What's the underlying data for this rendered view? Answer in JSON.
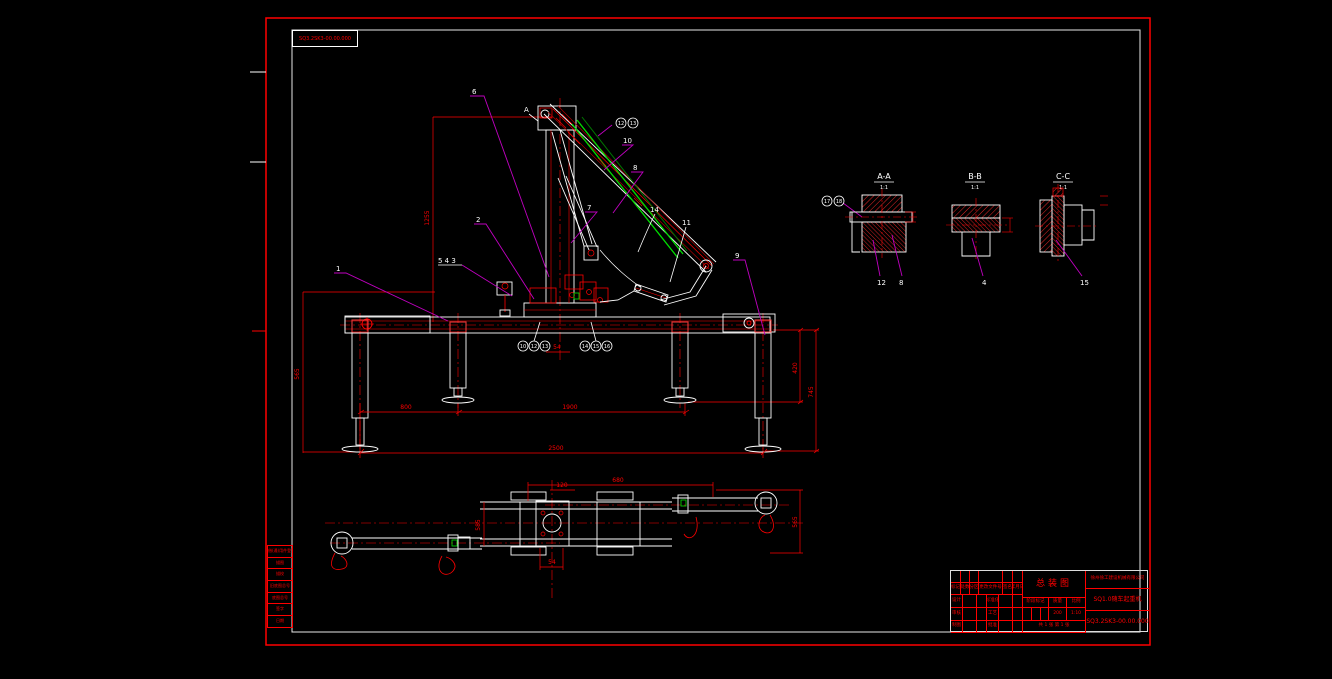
{
  "colors": {
    "background": "#000000",
    "frame_red": "#ff0000",
    "frame_white": "#ffffff",
    "line_white": "#ffffff",
    "line_red": "#ff0000",
    "leader_magenta": "#c000c0",
    "hose_green": "#00dd00"
  },
  "corner_box": {
    "code": "SQ3.2SK3-00.00.000"
  },
  "section_marker": {
    "label": "A"
  },
  "callouts": {
    "main": [
      {
        "label": "1"
      },
      {
        "label": "2"
      },
      {
        "label": "5 4 3"
      },
      {
        "label": "6"
      },
      {
        "label": "10"
      },
      {
        "label": "8"
      },
      {
        "label": "7"
      },
      {
        "label": "14"
      },
      {
        "label": "11"
      },
      {
        "label": "9"
      }
    ],
    "circled_top": [
      {
        "label": "12"
      },
      {
        "label": "13"
      }
    ],
    "circled_left": [
      {
        "label": "10"
      },
      {
        "label": "12"
      },
      {
        "label": "13"
      }
    ],
    "circled_right": [
      {
        "label": "14"
      },
      {
        "label": "15"
      },
      {
        "label": "16"
      }
    ]
  },
  "dimensions": {
    "main": [
      {
        "value": "1255"
      },
      {
        "value": "565"
      },
      {
        "value": "800"
      },
      {
        "value": "1900"
      },
      {
        "value": "2500"
      },
      {
        "value": "420"
      },
      {
        "value": "745"
      },
      {
        "value": "54"
      }
    ],
    "plan": [
      {
        "value": "680"
      },
      {
        "value": "120"
      },
      {
        "value": "585"
      },
      {
        "value": "565"
      },
      {
        "value": "54"
      }
    ]
  },
  "sections": [
    {
      "title": "A-A",
      "scale": "1:1",
      "balloons": [
        {
          "label": "17"
        },
        {
          "label": "18"
        }
      ],
      "leaders": [
        {
          "label": "12"
        },
        {
          "label": "8"
        }
      ]
    },
    {
      "title": "B-B",
      "scale": "1:1",
      "leaders": [
        {
          "label": "4"
        }
      ]
    },
    {
      "title": "C-C",
      "scale": "1:1",
      "leaders": [
        {
          "label": "15"
        }
      ]
    }
  ],
  "margin_table": {
    "rows": [
      {
        "label": "借(通)用件登记"
      },
      {
        "label": "描图"
      },
      {
        "label": "描校"
      },
      {
        "label": "旧底图总号"
      },
      {
        "label": "底图总号"
      },
      {
        "label": "签字"
      },
      {
        "label": "日期"
      }
    ]
  },
  "title_block": {
    "title": "总装图",
    "company": "徐州徐工建设机械有限公司",
    "product": "SQ1.0随车起重机",
    "drawing_no": "SQ3.2SK3-00.00.000",
    "row1": [
      "标记",
      "处数",
      "分区",
      "更改文件号",
      "签名",
      "年月日"
    ],
    "left_labels": [
      "设计",
      "标准化",
      "审核",
      "工艺",
      "制图",
      "批准"
    ],
    "stage_label": "阶段标记",
    "mass_label": "质量",
    "scale_label": "比例",
    "mass_value": "200",
    "scale_value": "1:10",
    "sheet_info": "共 1 张  第 1 张"
  }
}
